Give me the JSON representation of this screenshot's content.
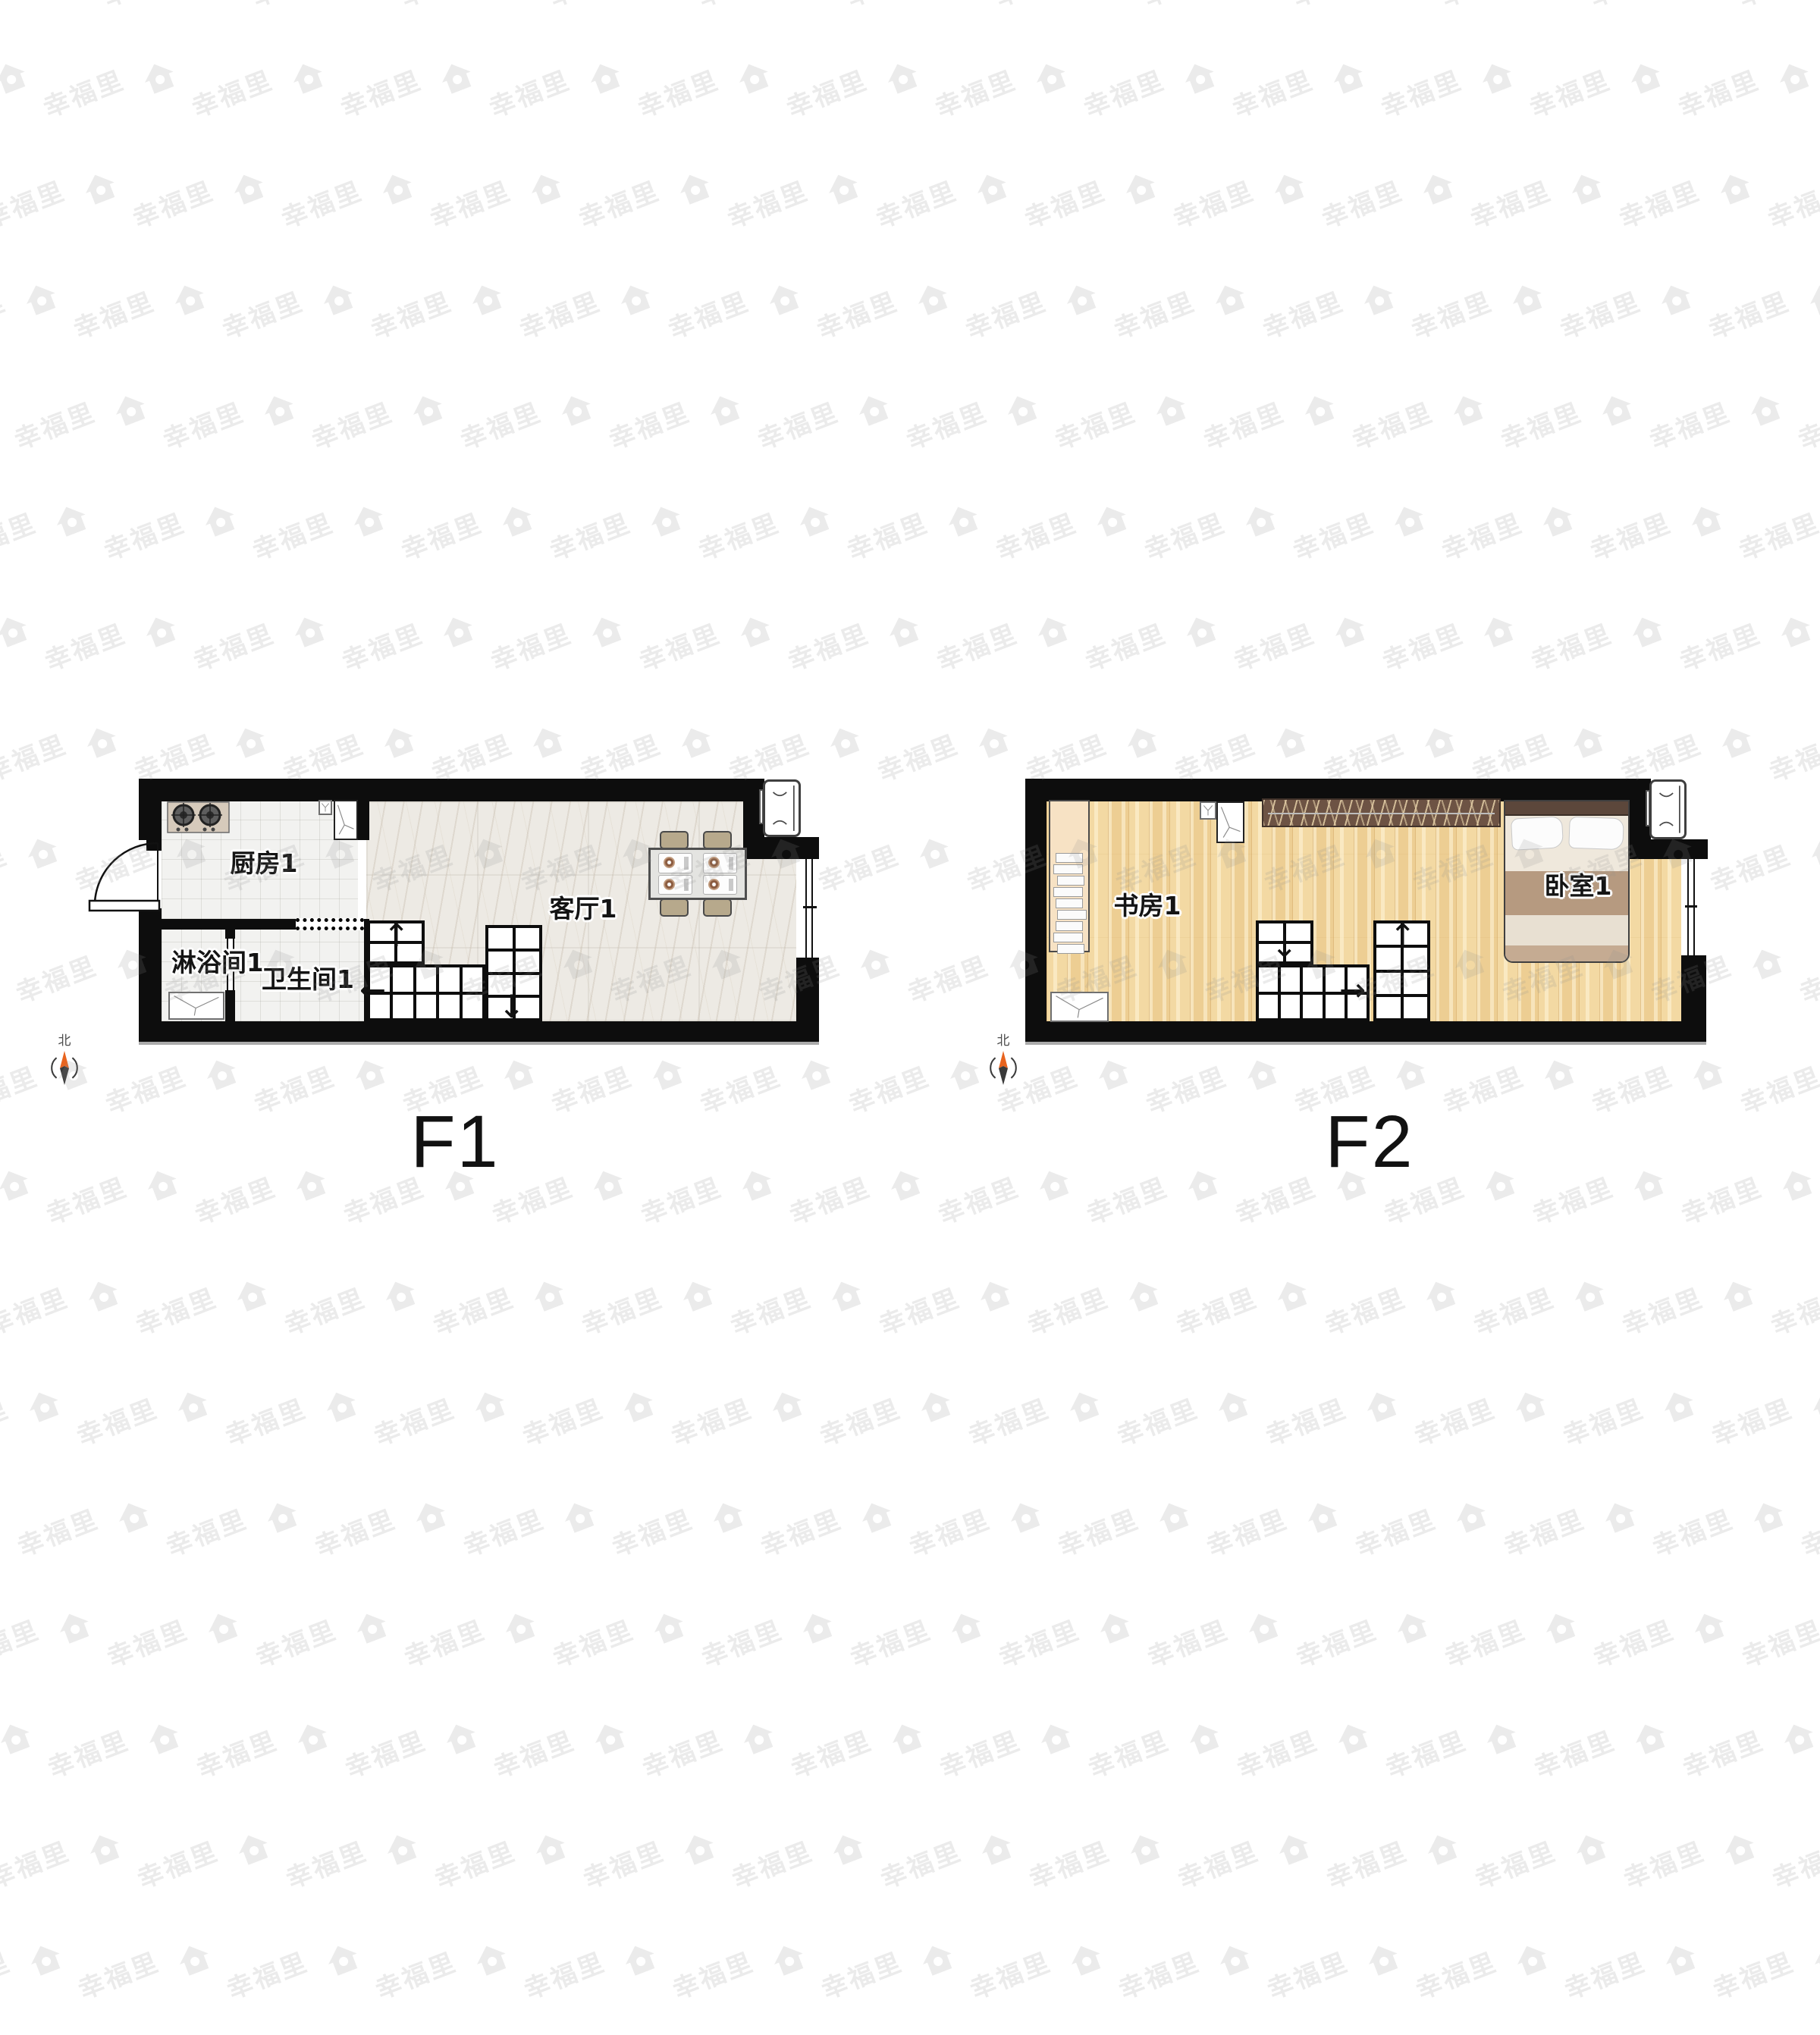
{
  "brand": {
    "watermark_text": "幸福里"
  },
  "compass": {
    "north_label": "北",
    "needle_north_color": "#e8641f",
    "needle_south_color": "#3a3a3a"
  },
  "floors": [
    {
      "title": "F1",
      "rooms": {
        "kitchen": "厨房1",
        "living": "客厅1",
        "shower": "淋浴间1",
        "bath": "卫生间1"
      }
    },
    {
      "title": "F2",
      "rooms": {
        "study": "书房1",
        "bedroom": "卧室1"
      }
    }
  ],
  "palette": {
    "wall": "#0d0d0d",
    "kitchen_tile": "#f2f2f0",
    "marble_floor": "#edeae4",
    "wood_floor": "#f3d9a3",
    "wardrobe": "#6d5344",
    "bed_headboard": "#5c473b",
    "bed_stripe": "#b69a80",
    "furniture_tan": "#b7a98c",
    "compass_north": "#e8641f"
  }
}
